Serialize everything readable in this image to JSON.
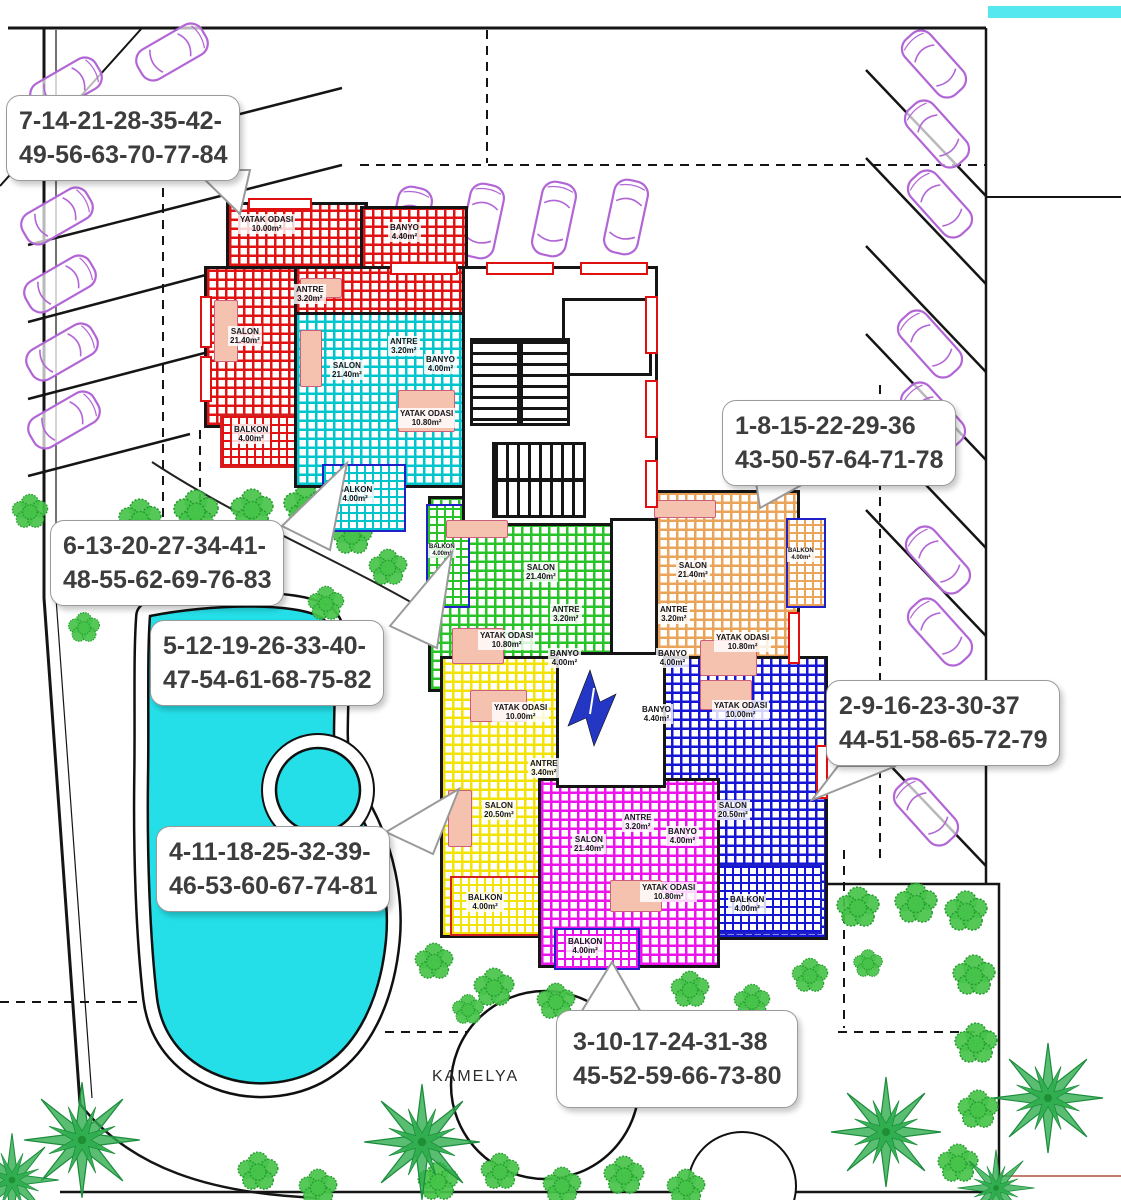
{
  "callouts": [
    {
      "lines": [
        "7-14-21-28-35-42-",
        "49-56-63-70-77-84"
      ]
    },
    {
      "lines": [
        "6-13-20-27-34-41-",
        "48-55-62-69-76-83"
      ]
    },
    {
      "lines": [
        "5-12-19-26-33-40-",
        "47-54-61-68-75-82"
      ]
    },
    {
      "lines": [
        "1-8-15-22-29-36",
        "43-50-57-64-71-78"
      ]
    },
    {
      "lines": [
        "2-9-16-23-30-37",
        "44-51-58-65-72-79"
      ]
    },
    {
      "lines": [
        "4-11-18-25-32-39-",
        "46-53-60-67-74-81"
      ]
    },
    {
      "lines": [
        "3-10-17-24-31-38",
        "45-52-59-66-73-80"
      ]
    }
  ],
  "site": {
    "kamelya": "KAMELYA"
  },
  "units": {
    "red": {
      "rooms": [
        {
          "label": "YATAK ODASI",
          "area": "10.00m²"
        },
        {
          "label": "BANYO",
          "area": "4.40m²"
        },
        {
          "label": "ANTRE",
          "area": "3.20m²"
        },
        {
          "label": "SALON",
          "area": "21.40m²"
        },
        {
          "label": "BALKON",
          "area": "4.00m²"
        }
      ]
    },
    "cyan": {
      "rooms": [
        {
          "label": "SALON",
          "area": "21.40m²"
        },
        {
          "label": "ANTRE",
          "area": "3.20m²"
        },
        {
          "label": "BANYO",
          "area": "4.00m²"
        },
        {
          "label": "YATAK ODASI",
          "area": "10.80m²"
        },
        {
          "label": "BALKON",
          "area": "4.00m²"
        }
      ]
    },
    "green": {
      "rooms": [
        {
          "label": "BALKON",
          "area": "4.00m²"
        },
        {
          "label": "SALON",
          "area": "21.40m²"
        },
        {
          "label": "ANTRE",
          "area": "3.20m²"
        },
        {
          "label": "YATAK ODASI",
          "area": "10.80m²"
        },
        {
          "label": "BANYO",
          "area": "4.00m²"
        }
      ]
    },
    "orange": {
      "rooms": [
        {
          "label": "SALON",
          "area": "21.40m²"
        },
        {
          "label": "BALKON",
          "area": "4.00m²"
        },
        {
          "label": "ANTRE",
          "area": "3.20m²"
        },
        {
          "label": "YATAK ODASI",
          "area": "10.80m²"
        },
        {
          "label": "BANYO",
          "area": "4.00m²"
        }
      ]
    },
    "yellow": {
      "rooms": [
        {
          "label": "YATAK ODASI",
          "area": "10.00m²"
        },
        {
          "label": "ANTRE",
          "area": "3.40m²"
        },
        {
          "label": "SALON",
          "area": "20.50m²"
        },
        {
          "label": "BALKON",
          "area": "4.00m²"
        }
      ]
    },
    "magenta": {
      "rooms": [
        {
          "label": "ANTRE",
          "area": "3.20m²"
        },
        {
          "label": "BANYO",
          "area": "4.00m²"
        },
        {
          "label": "SALON",
          "area": "21.40m²"
        },
        {
          "label": "YATAK ODASI",
          "area": "10.80m²"
        },
        {
          "label": "BALKON",
          "area": "4.00m²"
        }
      ]
    },
    "blue": {
      "rooms": [
        {
          "label": "BANYO",
          "area": "4.40m²"
        },
        {
          "label": "YATAK ODASI",
          "area": "10.00m²"
        },
        {
          "label": "SALON",
          "area": "20.50m²"
        },
        {
          "label": "BALKON",
          "area": "4.00m²"
        }
      ]
    }
  },
  "palette": {
    "wall": "#151515",
    "pool": "#25dfe8",
    "tree_green": "#46c34a",
    "car_purple": "#b266d6",
    "callout_text": "#3d3d3d",
    "red_unit": "#e01212",
    "cyan_unit": "#00c5cd",
    "green_unit": "#27c327",
    "orange_unit": "#eaa45a",
    "yellow_unit": "#f2e206",
    "magenta_unit": "#ec13ec",
    "blue_unit": "#1515d6",
    "road_strip": "#55e8ef"
  }
}
